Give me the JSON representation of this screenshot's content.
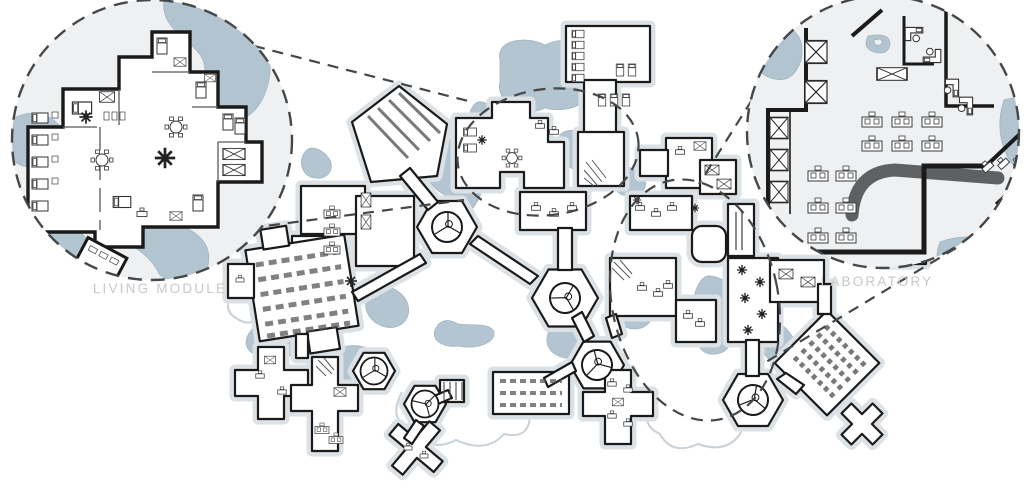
{
  "figure": {
    "type": "architectural-master-plan-with-detail-callouts",
    "callouts": [
      {
        "id": "living-module",
        "label": "LIVING MODULE",
        "position": "top-left",
        "marker": "dashed-circle",
        "icons": [
          "bed-icon",
          "dining-table-icon",
          "plant-icon",
          "storage-crate-icon"
        ]
      },
      {
        "id": "laboratory",
        "label": "LABORATORY",
        "position": "top-right",
        "marker": "dashed-circle",
        "icons": [
          "workbench-icon",
          "desk-computer-icon",
          "storage-crate-icon",
          "pond-icon"
        ]
      }
    ],
    "plan": {
      "highlight_regions": 2,
      "dome_count": 6,
      "module_kinds": [
        "living-module",
        "sleeping-quarters",
        "laboratory-wing",
        "assembly-hall",
        "greenhouse-corridor",
        "dome-pod",
        "cross-module",
        "rotated-hall"
      ]
    },
    "palette": {
      "walls": "#1a1a1a",
      "terrain": "#a9becb",
      "floor": "#eef0f1",
      "halo": "#dbe1e5",
      "dashes": "#454748",
      "label_text": "#c7c8c9"
    }
  }
}
